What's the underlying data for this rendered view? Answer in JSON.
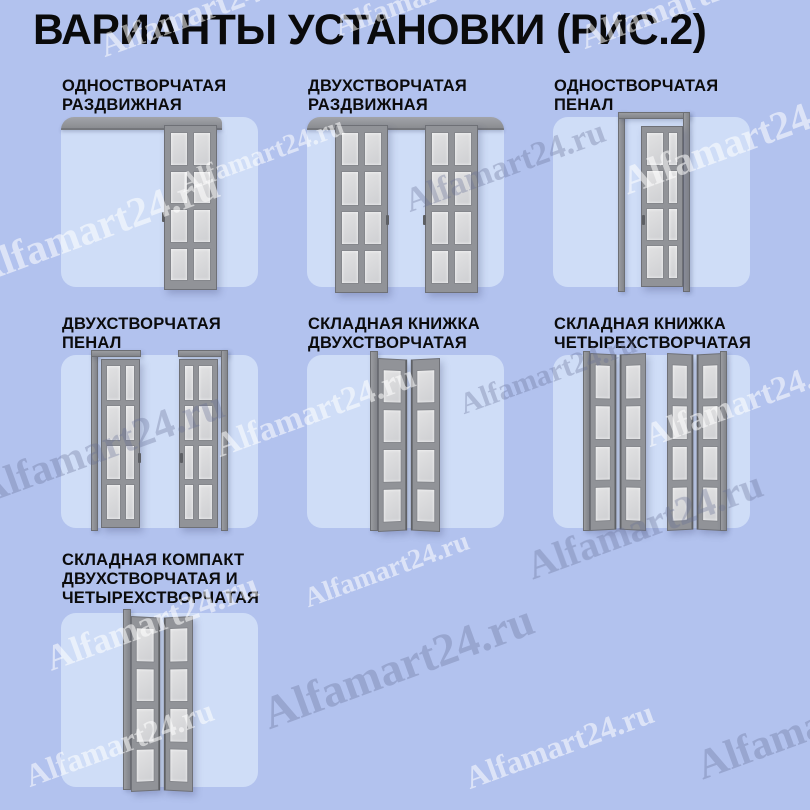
{
  "title": "ВАРИАНТЫ УСТАНОВКИ (РИС.2)",
  "watermark": {
    "text": "Alfamart24.ru"
  },
  "colors": {
    "bg": "#b2c2ee",
    "panel_bg": "#cfddf7",
    "door_frame": "#919398",
    "door_frame_dark": "#6e7076",
    "glass": "#d7d7d9",
    "rail": "#94969b",
    "title_text": "#0a0a0b",
    "watermark_light": "rgba(255,255,255,0.55)",
    "watermark_dark": "rgba(99,110,148,0.33)"
  },
  "panels": [
    {
      "id": "single-sliding",
      "lines": [
        "ОДНОСТВОРЧАТАЯ",
        "РАЗДВИЖНАЯ"
      ]
    },
    {
      "id": "double-sliding",
      "lines": [
        "ДВУХСТВОРЧАТАЯ",
        "РАЗДВИЖНАЯ"
      ]
    },
    {
      "id": "single-pocket",
      "lines": [
        "ОДНОСТВОРЧАТАЯ",
        "ПЕНАЛ"
      ]
    },
    {
      "id": "double-pocket",
      "lines": [
        "ДВУХСТВОРЧАТАЯ",
        "ПЕНАЛ"
      ]
    },
    {
      "id": "folding-book-double",
      "lines": [
        "СКЛАДНАЯ КНИЖКА",
        "ДВУХСТВОРЧАТАЯ"
      ]
    },
    {
      "id": "folding-book-quad",
      "lines": [
        "СКЛАДНАЯ КНИЖКА",
        "ЧЕТЫРЕХСТВОРЧАТАЯ"
      ]
    },
    {
      "id": "folding-compact",
      "lines": [
        "СКЛАДНАЯ КОМПАКТ",
        "ДВУХСТВОРЧАТАЯ И",
        "ЧЕТЫРЕХСТВОРЧАТАЯ"
      ]
    }
  ]
}
